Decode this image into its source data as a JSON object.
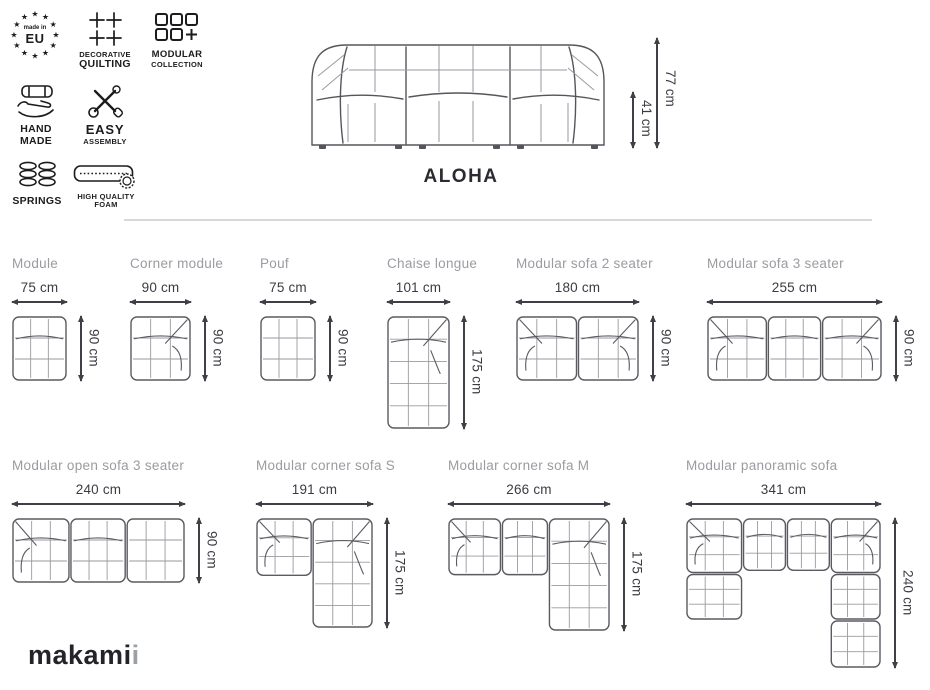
{
  "title": "ALOHA",
  "brand": {
    "name_main": "makami",
    "name_accent": "i"
  },
  "hero": {
    "total_height": "77 cm",
    "seat_height": "41 cm"
  },
  "features": [
    {
      "id": "made-in-eu",
      "line1": "made in",
      "line2": "EU"
    },
    {
      "id": "decorative-quilting",
      "line1": "DECORATIVE",
      "line2": "QUILTING"
    },
    {
      "id": "modular-collection",
      "line1": "MODULAR",
      "line2": "COLLECTION"
    },
    {
      "id": "hand-made",
      "line1": "HAND",
      "line2": "MADE"
    },
    {
      "id": "easy-assembly",
      "line1": "EASY",
      "line2": "ASSEMBLY"
    },
    {
      "id": "springs",
      "line1": "SPRINGS",
      "line2": ""
    },
    {
      "id": "high-quality-foam",
      "line1": "HIGH QUALITY",
      "line2": "FOAM"
    }
  ],
  "products": [
    {
      "name": "Module",
      "width": "75 cm",
      "depth": "90 cm"
    },
    {
      "name": "Corner module",
      "width": "90 cm",
      "depth": "90 cm"
    },
    {
      "name": "Pouf",
      "width": "75 cm",
      "depth": "90 cm"
    },
    {
      "name": "Chaise longue",
      "width": "101 cm",
      "depth": "175 cm"
    },
    {
      "name": "Modular sofa 2 seater",
      "width": "180 cm",
      "depth": "90 cm"
    },
    {
      "name": "Modular sofa 3 seater",
      "width": "255 cm",
      "depth": "90 cm"
    },
    {
      "name": "Modular open sofa 3 seater",
      "width": "240 cm",
      "depth": "90 cm"
    },
    {
      "name": "Modular corner sofa S",
      "width": "191 cm",
      "depth": "175 cm"
    },
    {
      "name": "Modular corner sofa M",
      "width": "266 cm",
      "depth": "175 cm"
    },
    {
      "name": "Modular panoramic sofa",
      "width": "341 cm",
      "depth": "240 cm"
    }
  ],
  "icons": {
    "star": "★"
  },
  "colors": {
    "line_dark": "#5a5a61",
    "line_light": "#9a9aa0",
    "arrow": "#3f3f46",
    "label_gray": "#9b9ba1",
    "dim_text": "#3b3b43",
    "divider": "#d8d8d8",
    "ink": "#1c1c1f"
  }
}
